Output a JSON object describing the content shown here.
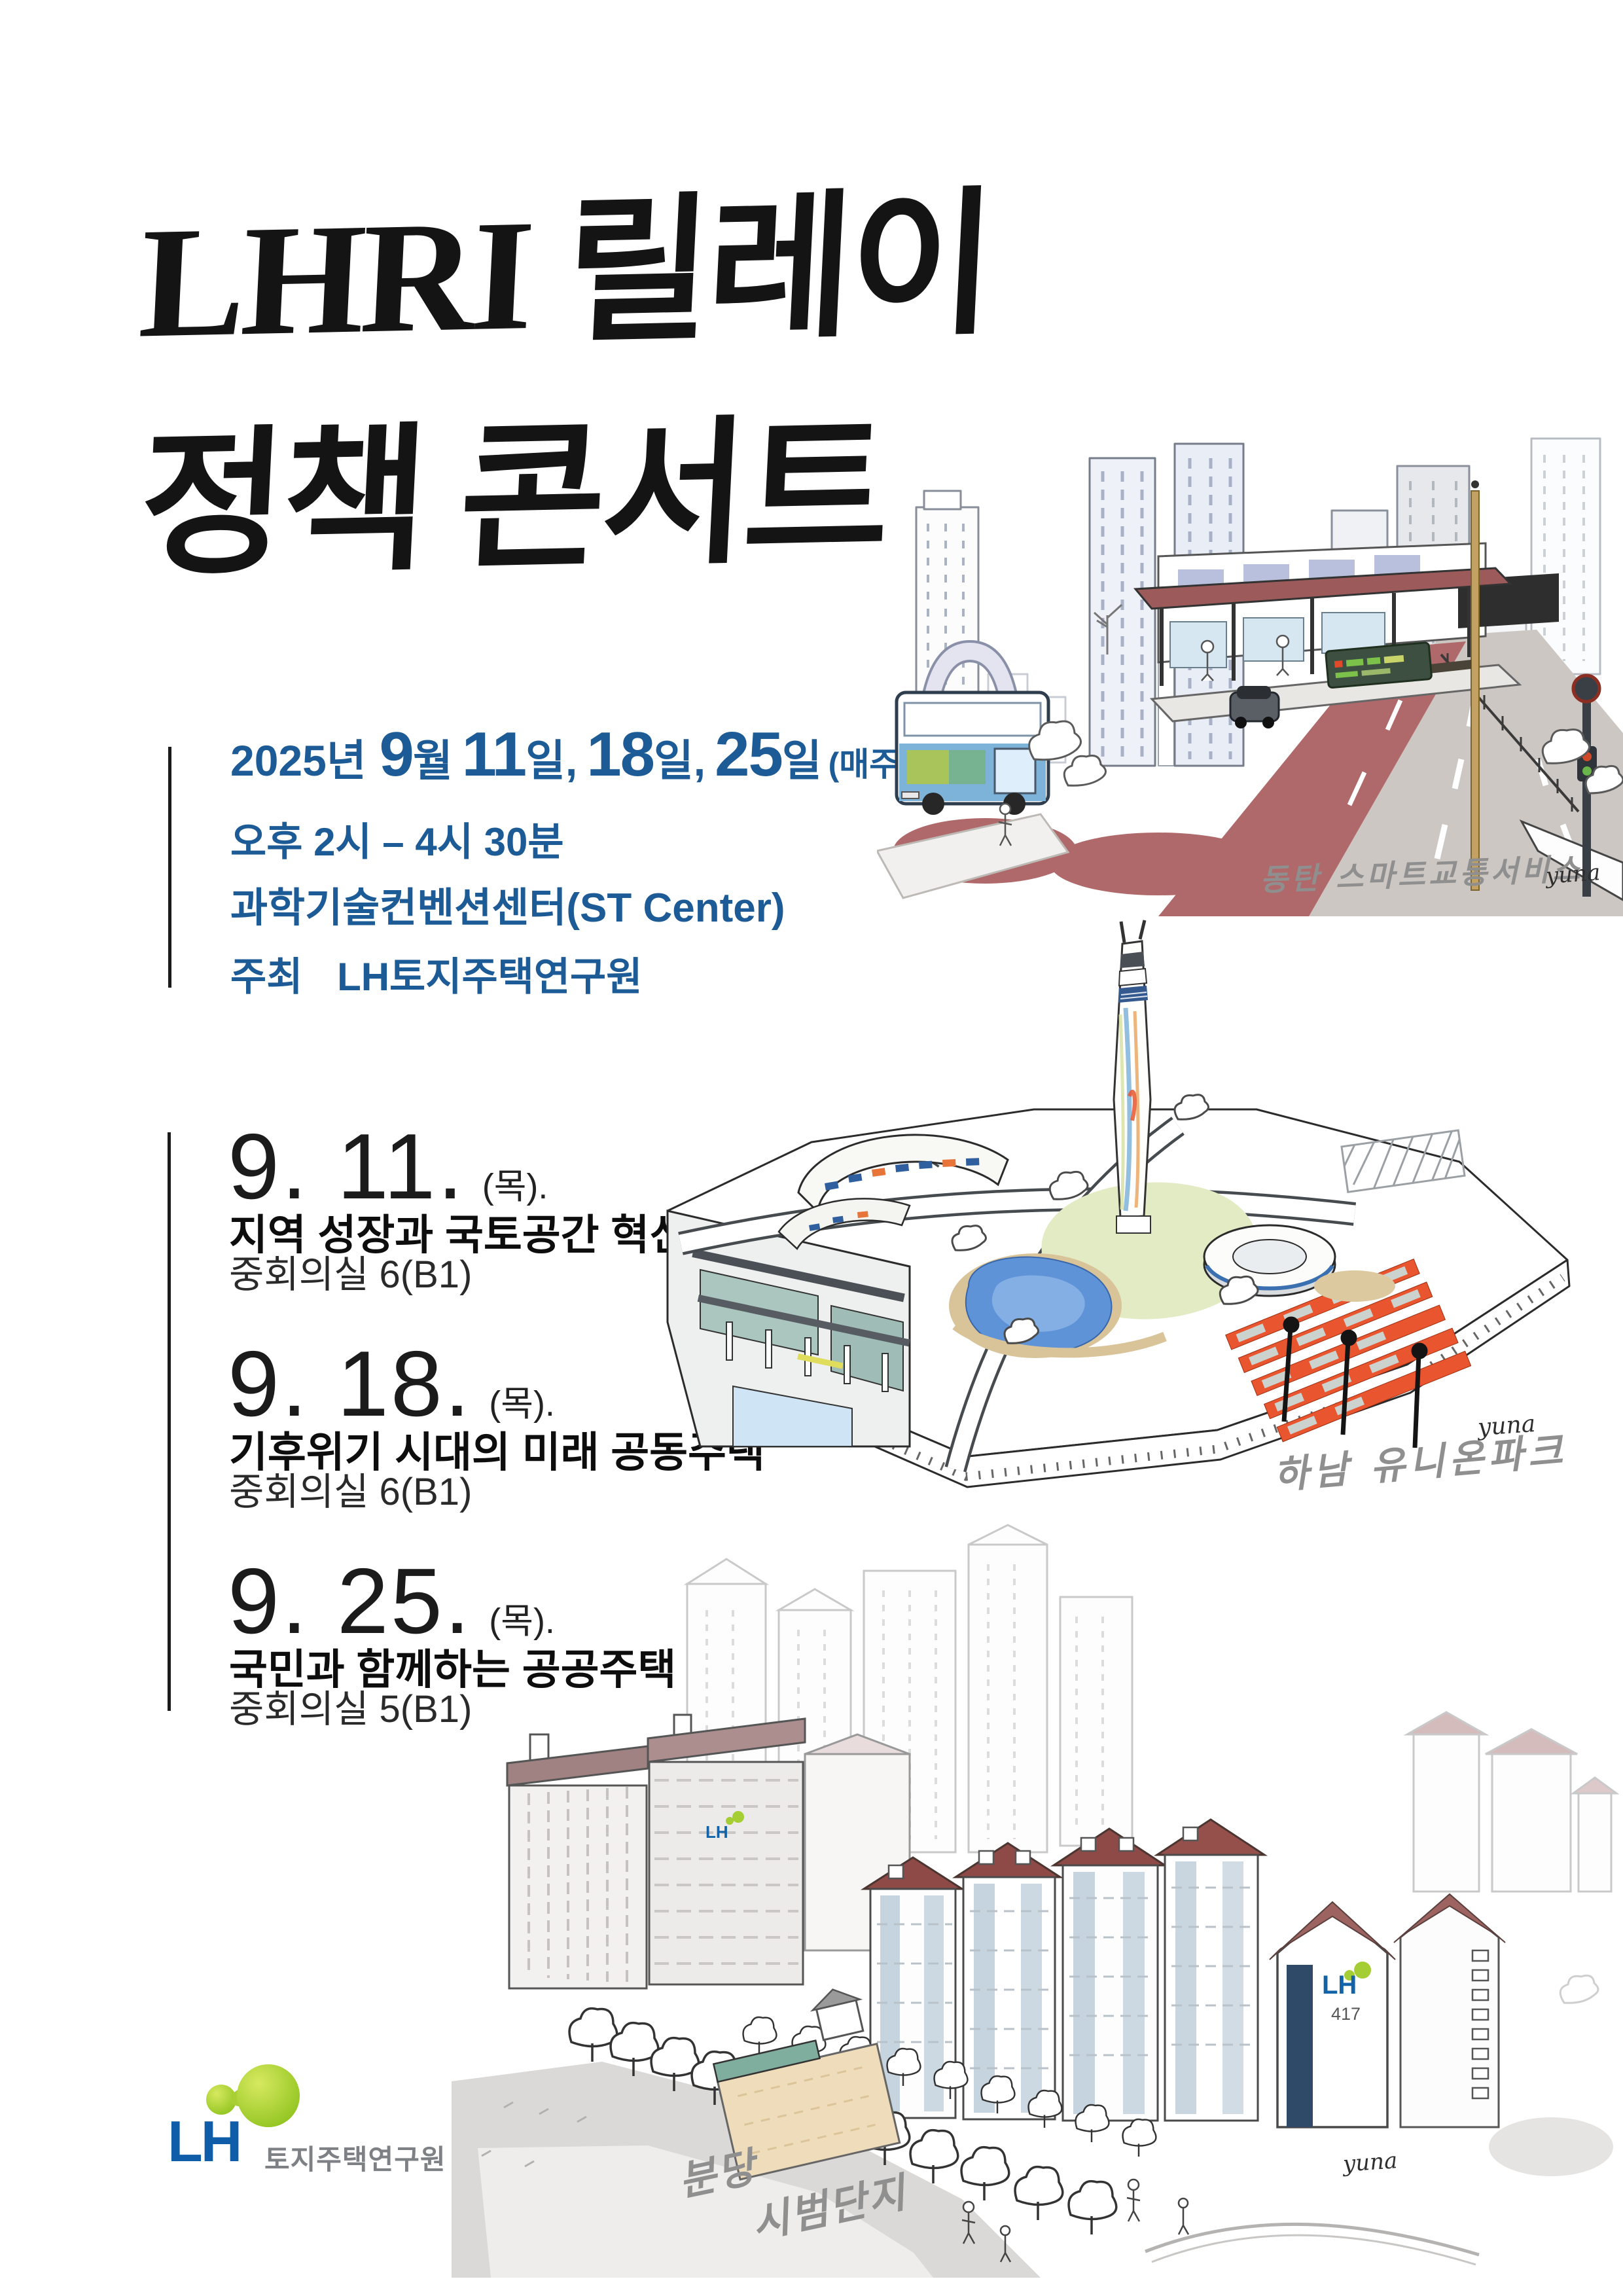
{
  "poster": {
    "title": {
      "line1": "LHRI 릴레이",
      "line2": "정책 콘서트"
    },
    "info": {
      "year": "2025년",
      "month_num": "9",
      "month_suffix": "월",
      "days": [
        {
          "num": "11",
          "suffix": "일,"
        },
        {
          "num": "18",
          "suffix": "일,"
        },
        {
          "num": "25",
          "suffix": "일"
        }
      ],
      "weekly_note": "(매주 목요일)",
      "time": "오후 2시 – 4시 30분",
      "venue": "과학기술컨벤션센터(ST Center)",
      "host_label": "주최",
      "host_name": "LH토지주택연구원"
    },
    "schedule": [
      {
        "date": "9. 11.",
        "day": "(목).",
        "title": "지역 성장과 국토공간 혁신",
        "room": "중회의실 6(B1)"
      },
      {
        "date": "9. 18.",
        "day": "(목).",
        "title": "기후위기 시대의 미래 공동주택",
        "room": "중회의실 6(B1)"
      },
      {
        "date": "9. 25.",
        "day": "(목).",
        "title": "국민과 함께하는 공공주택",
        "room": "중회의실 5(B1)"
      }
    ],
    "illustrations": {
      "dongtan": {
        "caption": "동탄 스마트교통서비스",
        "signature": "yuna"
      },
      "hanam": {
        "caption": "하남 유니온파크",
        "signature": "yuna"
      },
      "bundang": {
        "caption_line1": "분당",
        "caption_line2": "시범단지",
        "signature": "yuna",
        "building_label": "LH",
        "building_number": "417"
      }
    },
    "logo": {
      "lh": "LH",
      "org_name": "토지주택연구원"
    },
    "colors": {
      "text_blue": "#1d5b96",
      "ink_black": "#141414",
      "caption_gray": "#8f8f8f",
      "lh_blue": "#0f5ca8",
      "lh_green": "#9ec92e",
      "brt_red": "#b0696a",
      "road_gray": "#c8c4c0",
      "roof_maroon": "#8d4a46",
      "navy_panel": "#2e4a68",
      "orange_accent": "#e8552e",
      "pond_blue": "#5e93d8",
      "lawn_green": "#e3ebc4",
      "teal_pool": "#abc5bf",
      "bus_blue": "#7db3d9"
    }
  }
}
